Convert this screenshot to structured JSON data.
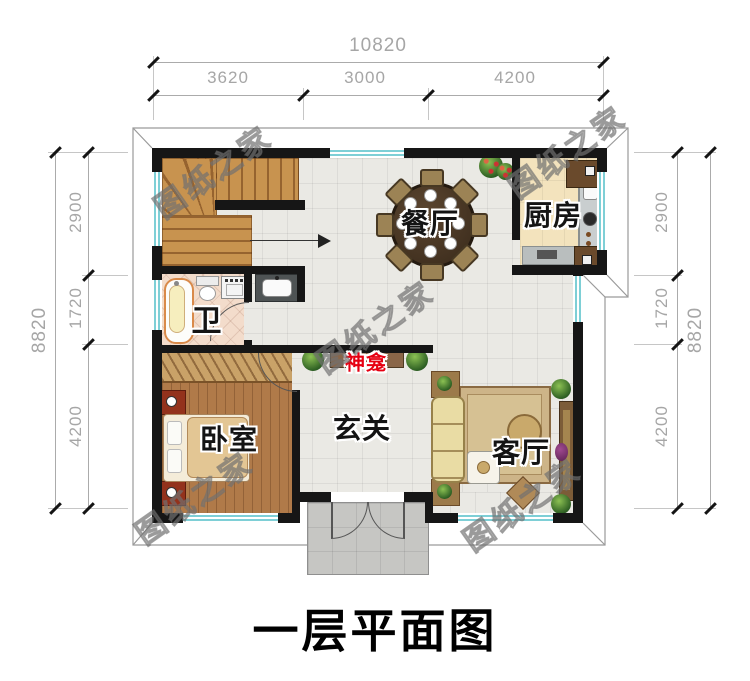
{
  "labels": {
    "title": "一层平面图",
    "watermark": "图纸之家",
    "dining": "餐厅",
    "kitchen": "厨房",
    "bath": "卫",
    "bedroom": "卧室",
    "foyer": "玄关",
    "living": "客厅",
    "shrine": "神龛"
  },
  "dimensions": {
    "top": {
      "total": "10820",
      "segments": [
        "3620",
        "3000",
        "4200"
      ]
    },
    "left": {
      "total": "8820",
      "segments": [
        "2900",
        "1720",
        "4200"
      ]
    },
    "right": {
      "total": "8820",
      "segments": [
        "2900",
        "1720",
        "4200"
      ]
    }
  },
  "colors": {
    "wall": "#161616",
    "window": "#7ecfd6",
    "shrine-red": "#e60012",
    "dim-text": "#a6a6a6",
    "tile": "#eae9e4",
    "kitchen-floor": "#f3e3bd",
    "bath-floor": "#f3dccb",
    "bedroom-wood": "#b07a49",
    "stair-wood": "#c8934f",
    "porch": "#c6c6c3"
  }
}
